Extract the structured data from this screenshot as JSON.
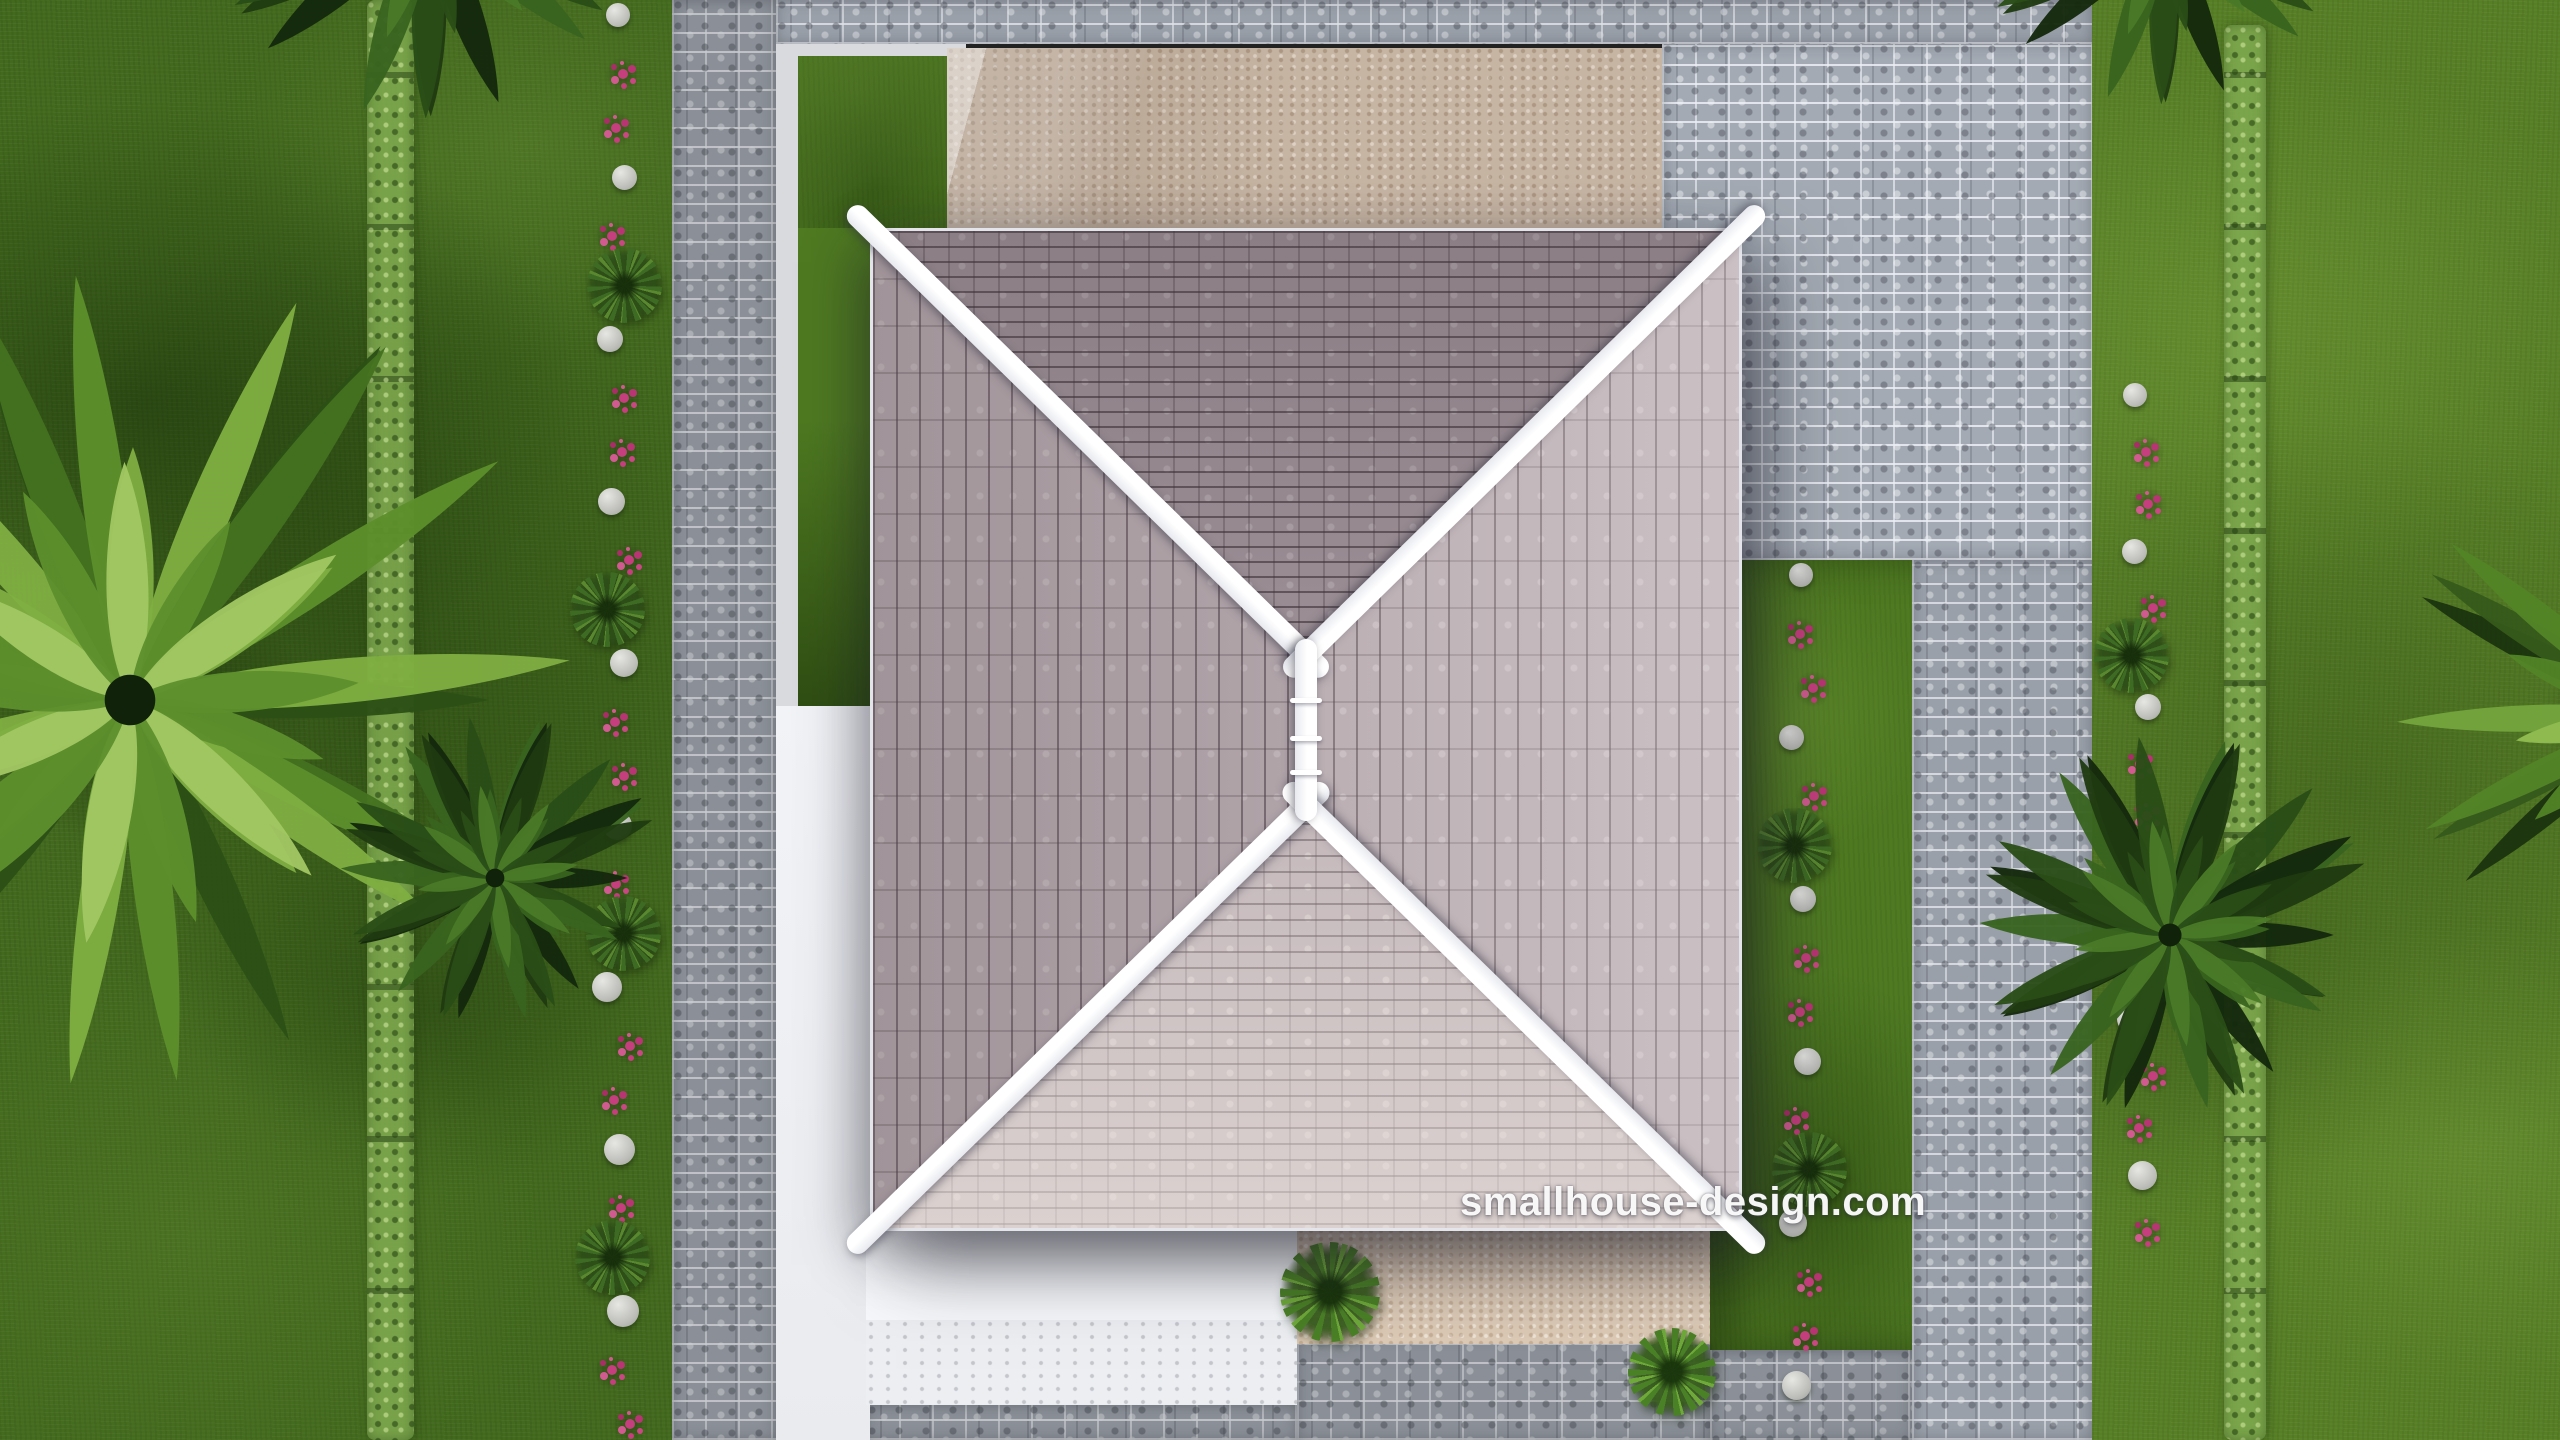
{
  "watermark": {
    "text": "smallhouse-design.com"
  },
  "colors": {
    "grass_dark": "#42691d",
    "grass_bright": "#577f26",
    "hedge_green": "#80aa50",
    "cobble_gray": "#9aa0a9",
    "cobble_mortar": "#d8dbe0",
    "pad_beige": "#c7b5a4",
    "walk_beige": "#dccab6",
    "white_paving": "#eff1f5",
    "roof_top_face": "#a2959c",
    "roof_side_face": "#b5a9ae",
    "roof_bottom_face": "#c2b6b9",
    "ridge_white": "#f5f6f9",
    "flower_pink": "#c53e7d",
    "border_stone": "#d5d6d3",
    "shrub_green": "#4a8026"
  },
  "roof": {
    "left": 870,
    "top": 228,
    "right": 1742,
    "bottom": 1231,
    "ridge_top_junction": {
      "x": 1306,
      "y": 655
    },
    "ridge_bottom_junction": {
      "x": 1306,
      "y": 805
    },
    "ridge_width": 22,
    "cap_extension": 28,
    "ridge_ticks_y": [
      700,
      738,
      772
    ]
  },
  "landscape": {
    "hedges": [
      {
        "name": "left-hedge",
        "x": 367,
        "y": 0,
        "w": 47,
        "h": 1440
      },
      {
        "name": "right-hedge",
        "x": 2224,
        "y": 25,
        "w": 42,
        "h": 1415
      }
    ],
    "flower_lines": [
      {
        "name": "left-lawn-border",
        "x": 616,
        "y_start": 15,
        "y_end": 1430,
        "step": 54
      },
      {
        "name": "house-right-border",
        "x": 1800,
        "y_start": 575,
        "y_end": 1430,
        "step": 54
      },
      {
        "name": "right-lawn-border",
        "x": 2140,
        "y_start": 395,
        "y_end": 1245,
        "step": 52
      }
    ],
    "palms": [
      {
        "name": "left-coconut-palm",
        "cx": 130,
        "cy": 700,
        "r": 460,
        "fronds": 24,
        "tone": "light"
      },
      {
        "name": "left-sago-palm",
        "cx": 495,
        "cy": 878,
        "r": 170,
        "fronds": 30,
        "tone": "dark"
      },
      {
        "name": "top-left-palm",
        "cx": 430,
        "cy": -90,
        "r": 250,
        "fronds": 22,
        "tone": "dark"
      },
      {
        "name": "top-right-palm",
        "cx": 2165,
        "cy": -75,
        "r": 215,
        "fronds": 22,
        "tone": "dark"
      },
      {
        "name": "right-sago-palm",
        "cx": 2170,
        "cy": 935,
        "r": 210,
        "fronds": 30,
        "tone": "dark"
      },
      {
        "name": "right-edge-palm",
        "cx": 2660,
        "cy": 715,
        "r": 300,
        "fronds": 22,
        "tone": "mixed"
      }
    ],
    "walkway_plants": [
      {
        "x": 1330,
        "y": 1292,
        "r": 50
      },
      {
        "x": 1672,
        "y": 1372,
        "r": 44
      }
    ]
  }
}
